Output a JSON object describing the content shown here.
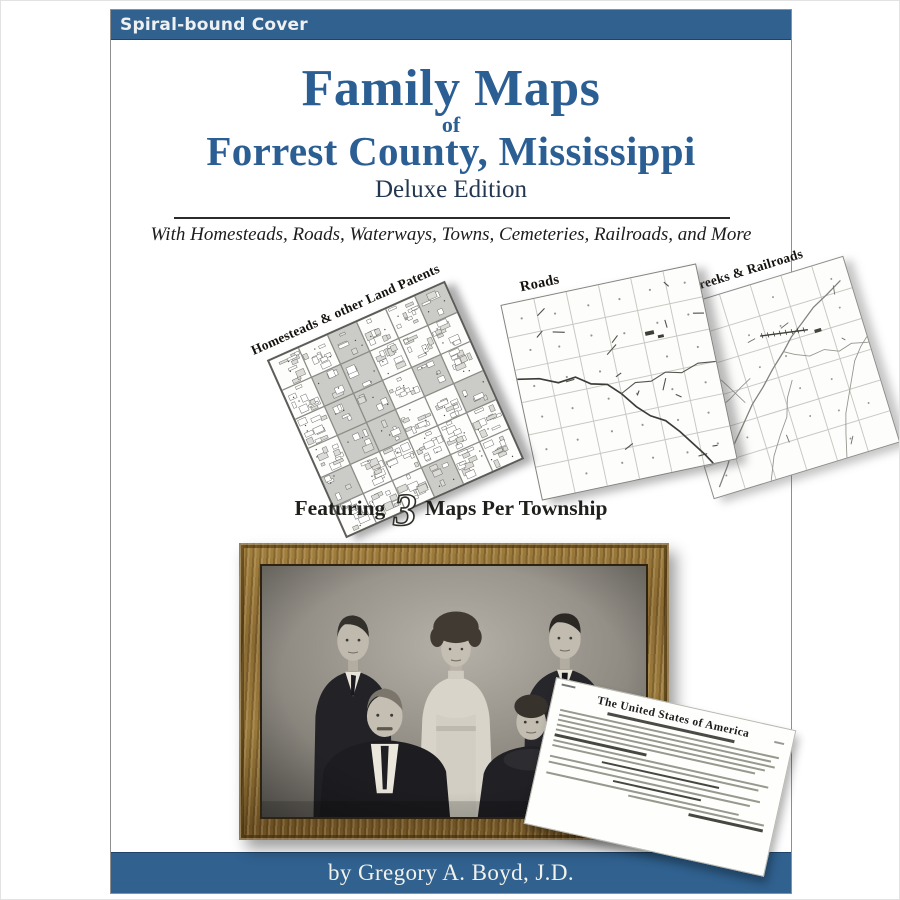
{
  "banner": {
    "label": "Spiral-bound Cover"
  },
  "title": {
    "line1": "Family Maps",
    "connector": "of",
    "line2": "Forrest County, Mississippi",
    "edition": "Deluxe Edition"
  },
  "tagline": "With Homesteads, Roads, Waterways, Towns, Cemeteries, Railroads, and More",
  "maps": [
    {
      "id": "homesteads",
      "label": "Homesteads & other Land Patents"
    },
    {
      "id": "roads",
      "label": "Roads"
    },
    {
      "id": "rivers",
      "label": "Rivers, Creeks & Railroads"
    }
  ],
  "featuring": {
    "prefix": "Featuring",
    "number": "3",
    "suffix": "Maps Per Township"
  },
  "document": {
    "heading": "The United States of America"
  },
  "byline": "by Gregory A. Boyd, J.D.",
  "colors": {
    "banner_blue": "#30618f",
    "title_blue": "#2b5f94",
    "edition_navy": "#233750",
    "rule_dark": "#2b2b2b"
  }
}
